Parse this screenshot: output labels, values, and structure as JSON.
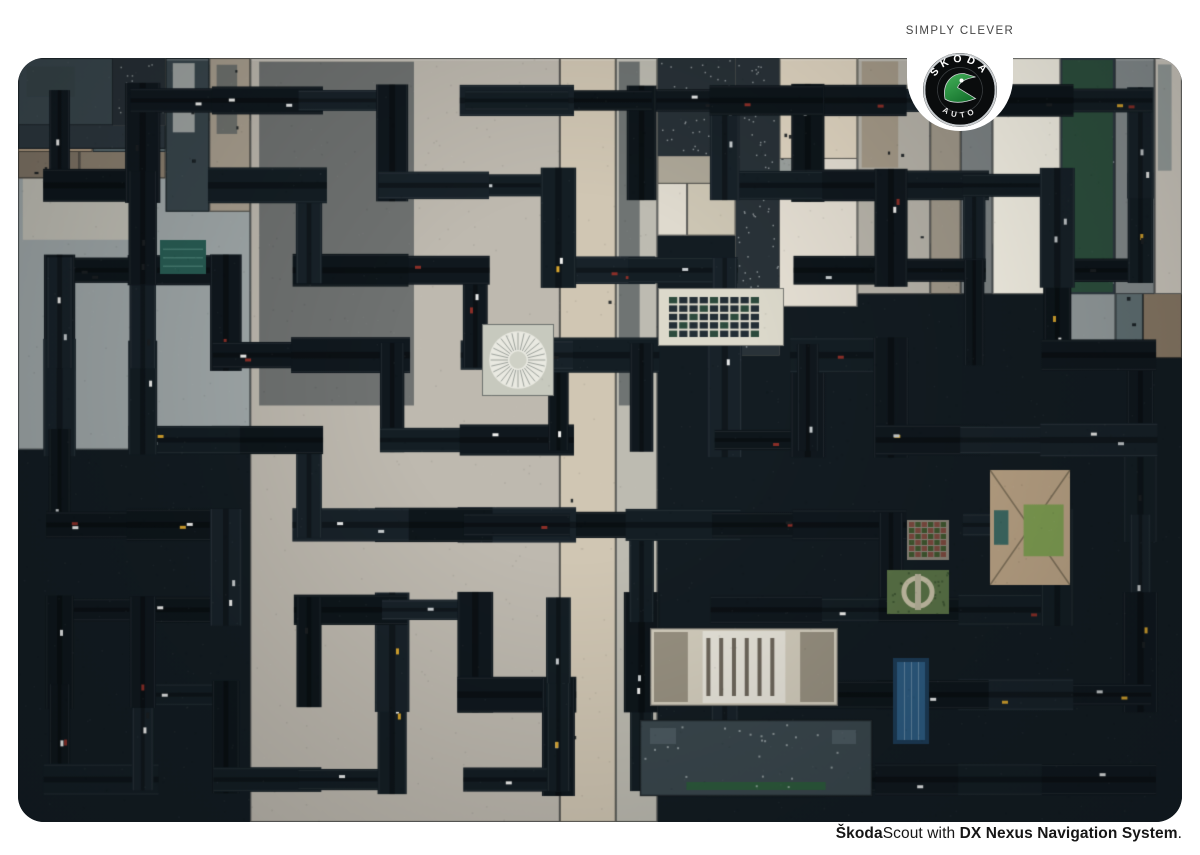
{
  "brand": {
    "tagline": "SIMPLY CLEVER",
    "logo": {
      "top_text": "SKODA",
      "bottom_text": "AUTO",
      "badge_color": "#0a0c0d",
      "ring_color": "#c9cdd0",
      "wing_green_light": "#45b25a",
      "wing_green_dark": "#17752f"
    }
  },
  "footer": {
    "brand_bold": "Škoda",
    "model": "Scout",
    "connector": " with ",
    "system_bold": "DX Nexus Navigation System",
    "period": "."
  },
  "photo": {
    "palette": {
      "road": "#131c22",
      "road_tones": [
        "#10181e",
        "#141e24",
        "#182229",
        "#0e161b"
      ],
      "blocks": [
        "#c9c2b1",
        "#d6d3c8",
        "#bdb4a3",
        "#8f9697",
        "#708185",
        "#3b484e",
        "#2b353b",
        "#ccc0a6",
        "#a59c8c",
        "#5c6b6f",
        "#dbd9d1",
        "#8a7e6d",
        "#c3beb4",
        "#97856f"
      ],
      "greens": [
        "#39604a",
        "#4c6e44",
        "#2f5340"
      ],
      "cars": [
        "#e8eaea",
        "#c9ced0",
        "#8c2f28",
        "#1b1f22",
        "#d9a62e",
        "#f2f2f0"
      ]
    },
    "maze": {
      "cols": 14,
      "rows": 9,
      "seed": 20,
      "extra_links": 18,
      "road_min": 20,
      "road_max": 36
    },
    "landmarks": [
      {
        "type": "round-plaza",
        "x": 464,
        "y": 266,
        "w": 72,
        "h": 72
      },
      {
        "type": "solar-roof",
        "x": 640,
        "y": 230,
        "w": 126,
        "h": 58
      },
      {
        "type": "park-circle",
        "x": 869,
        "y": 512,
        "w": 62,
        "h": 44
      },
      {
        "type": "roof-garden",
        "x": 889,
        "y": 462,
        "w": 42,
        "h": 40
      },
      {
        "type": "lawn-tower",
        "x": 972,
        "y": 412,
        "w": 80,
        "h": 115
      },
      {
        "type": "teal-pool",
        "x": 142,
        "y": 182,
        "w": 46,
        "h": 34
      },
      {
        "type": "theater",
        "x": 632,
        "y": 570,
        "w": 188,
        "h": 78
      },
      {
        "type": "blue-pool",
        "x": 875,
        "y": 600,
        "w": 36,
        "h": 86
      },
      {
        "type": "slate-hall",
        "x": 622,
        "y": 662,
        "w": 232,
        "h": 76
      }
    ]
  }
}
